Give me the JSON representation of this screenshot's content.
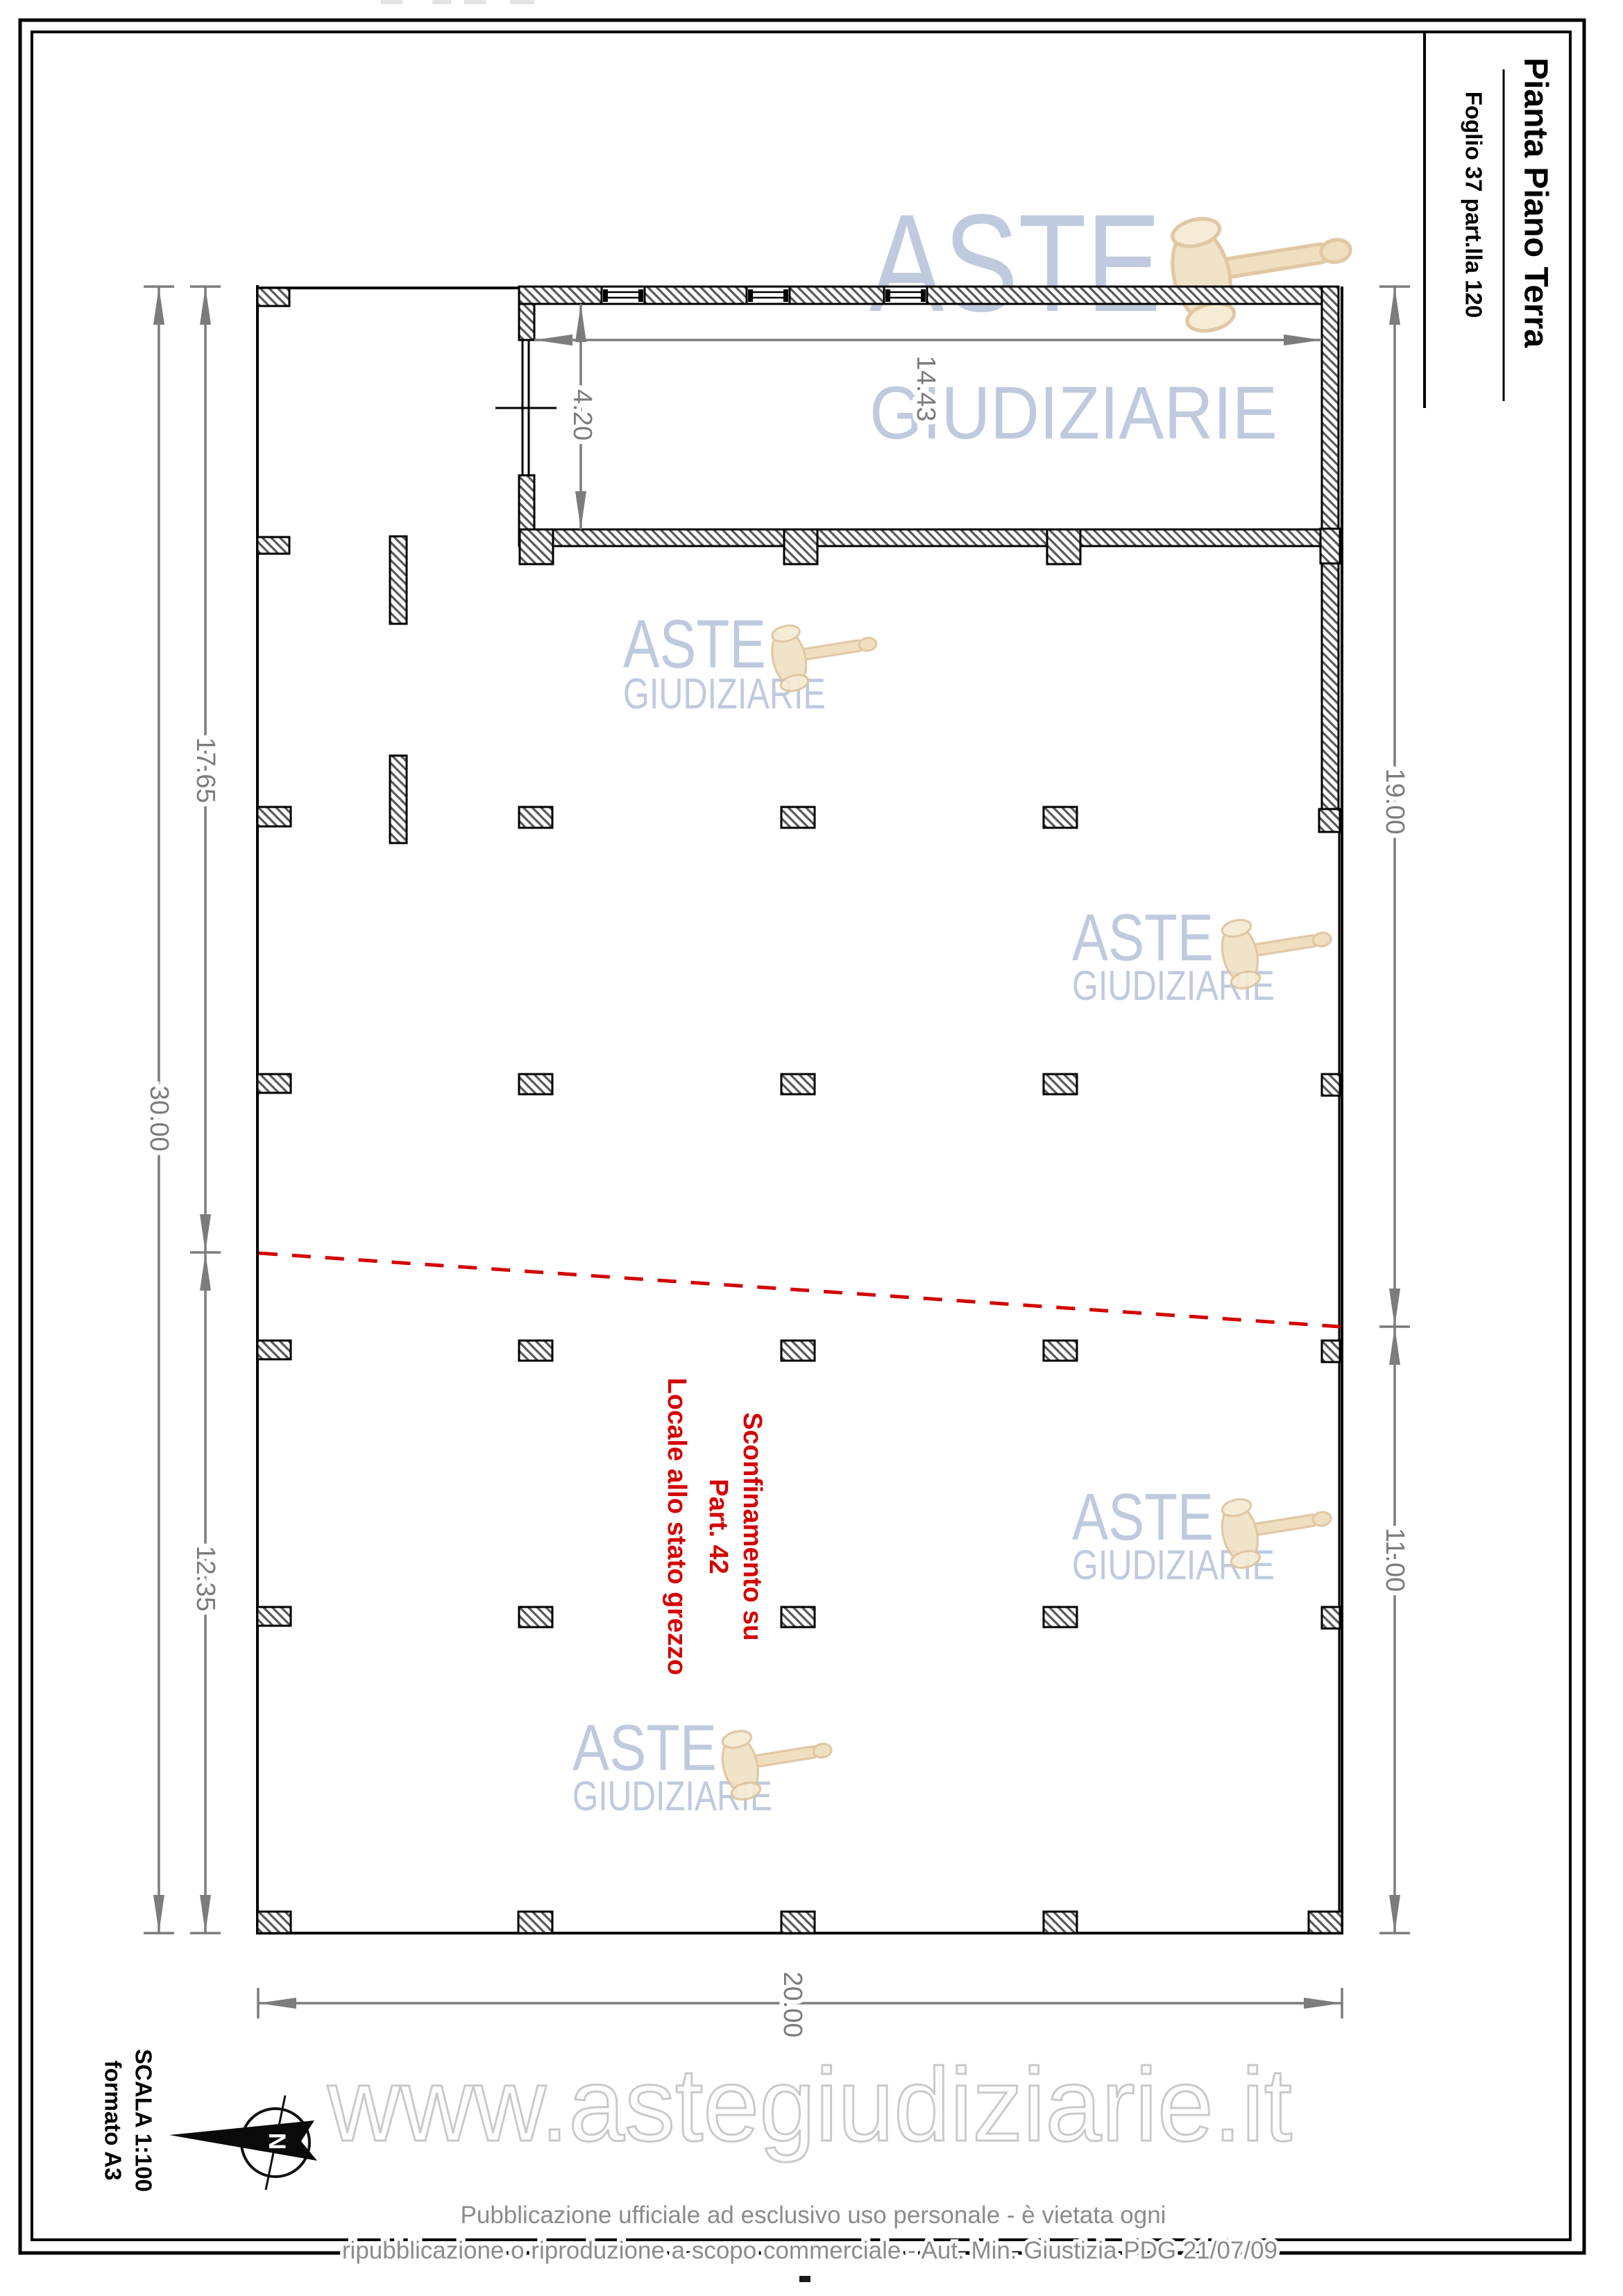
{
  "title_block": {
    "title": "Pianta Piano Terra",
    "subtitle": "Foglio 37 part.lla 120"
  },
  "dimensions": {
    "room_height": "4.20",
    "room_width": "14.43",
    "left_upper": "17.65",
    "left_total": "30.00",
    "left_lower": "12.35",
    "right_upper": "19.00",
    "right_lower": "11.00",
    "bottom_width": "20.00"
  },
  "annotation": {
    "line1": "Sconfinamento su",
    "line2": "Part. 42",
    "line3": "Locale allo stato grezzo",
    "color": "#d40000"
  },
  "scale_block": {
    "line1": "SCALA 1:100",
    "line2": "formato A3"
  },
  "compass": {
    "north_label": "N"
  },
  "watermark": {
    "word1": "ASTE",
    "word2": "GIUDIZIARIE",
    "website": "www.astegiudiziarie.it",
    "text_color": "#aebcd6",
    "gavel_color": "#eedcba"
  },
  "footer": {
    "line1": "Pubblicazione ufficiale ad esclusivo uso personale - è vietata ogni",
    "line2": "ripubblicazione o riproduzione a scopo commerciale - Aut. Min. Giustizia PDG 21/07/09"
  }
}
